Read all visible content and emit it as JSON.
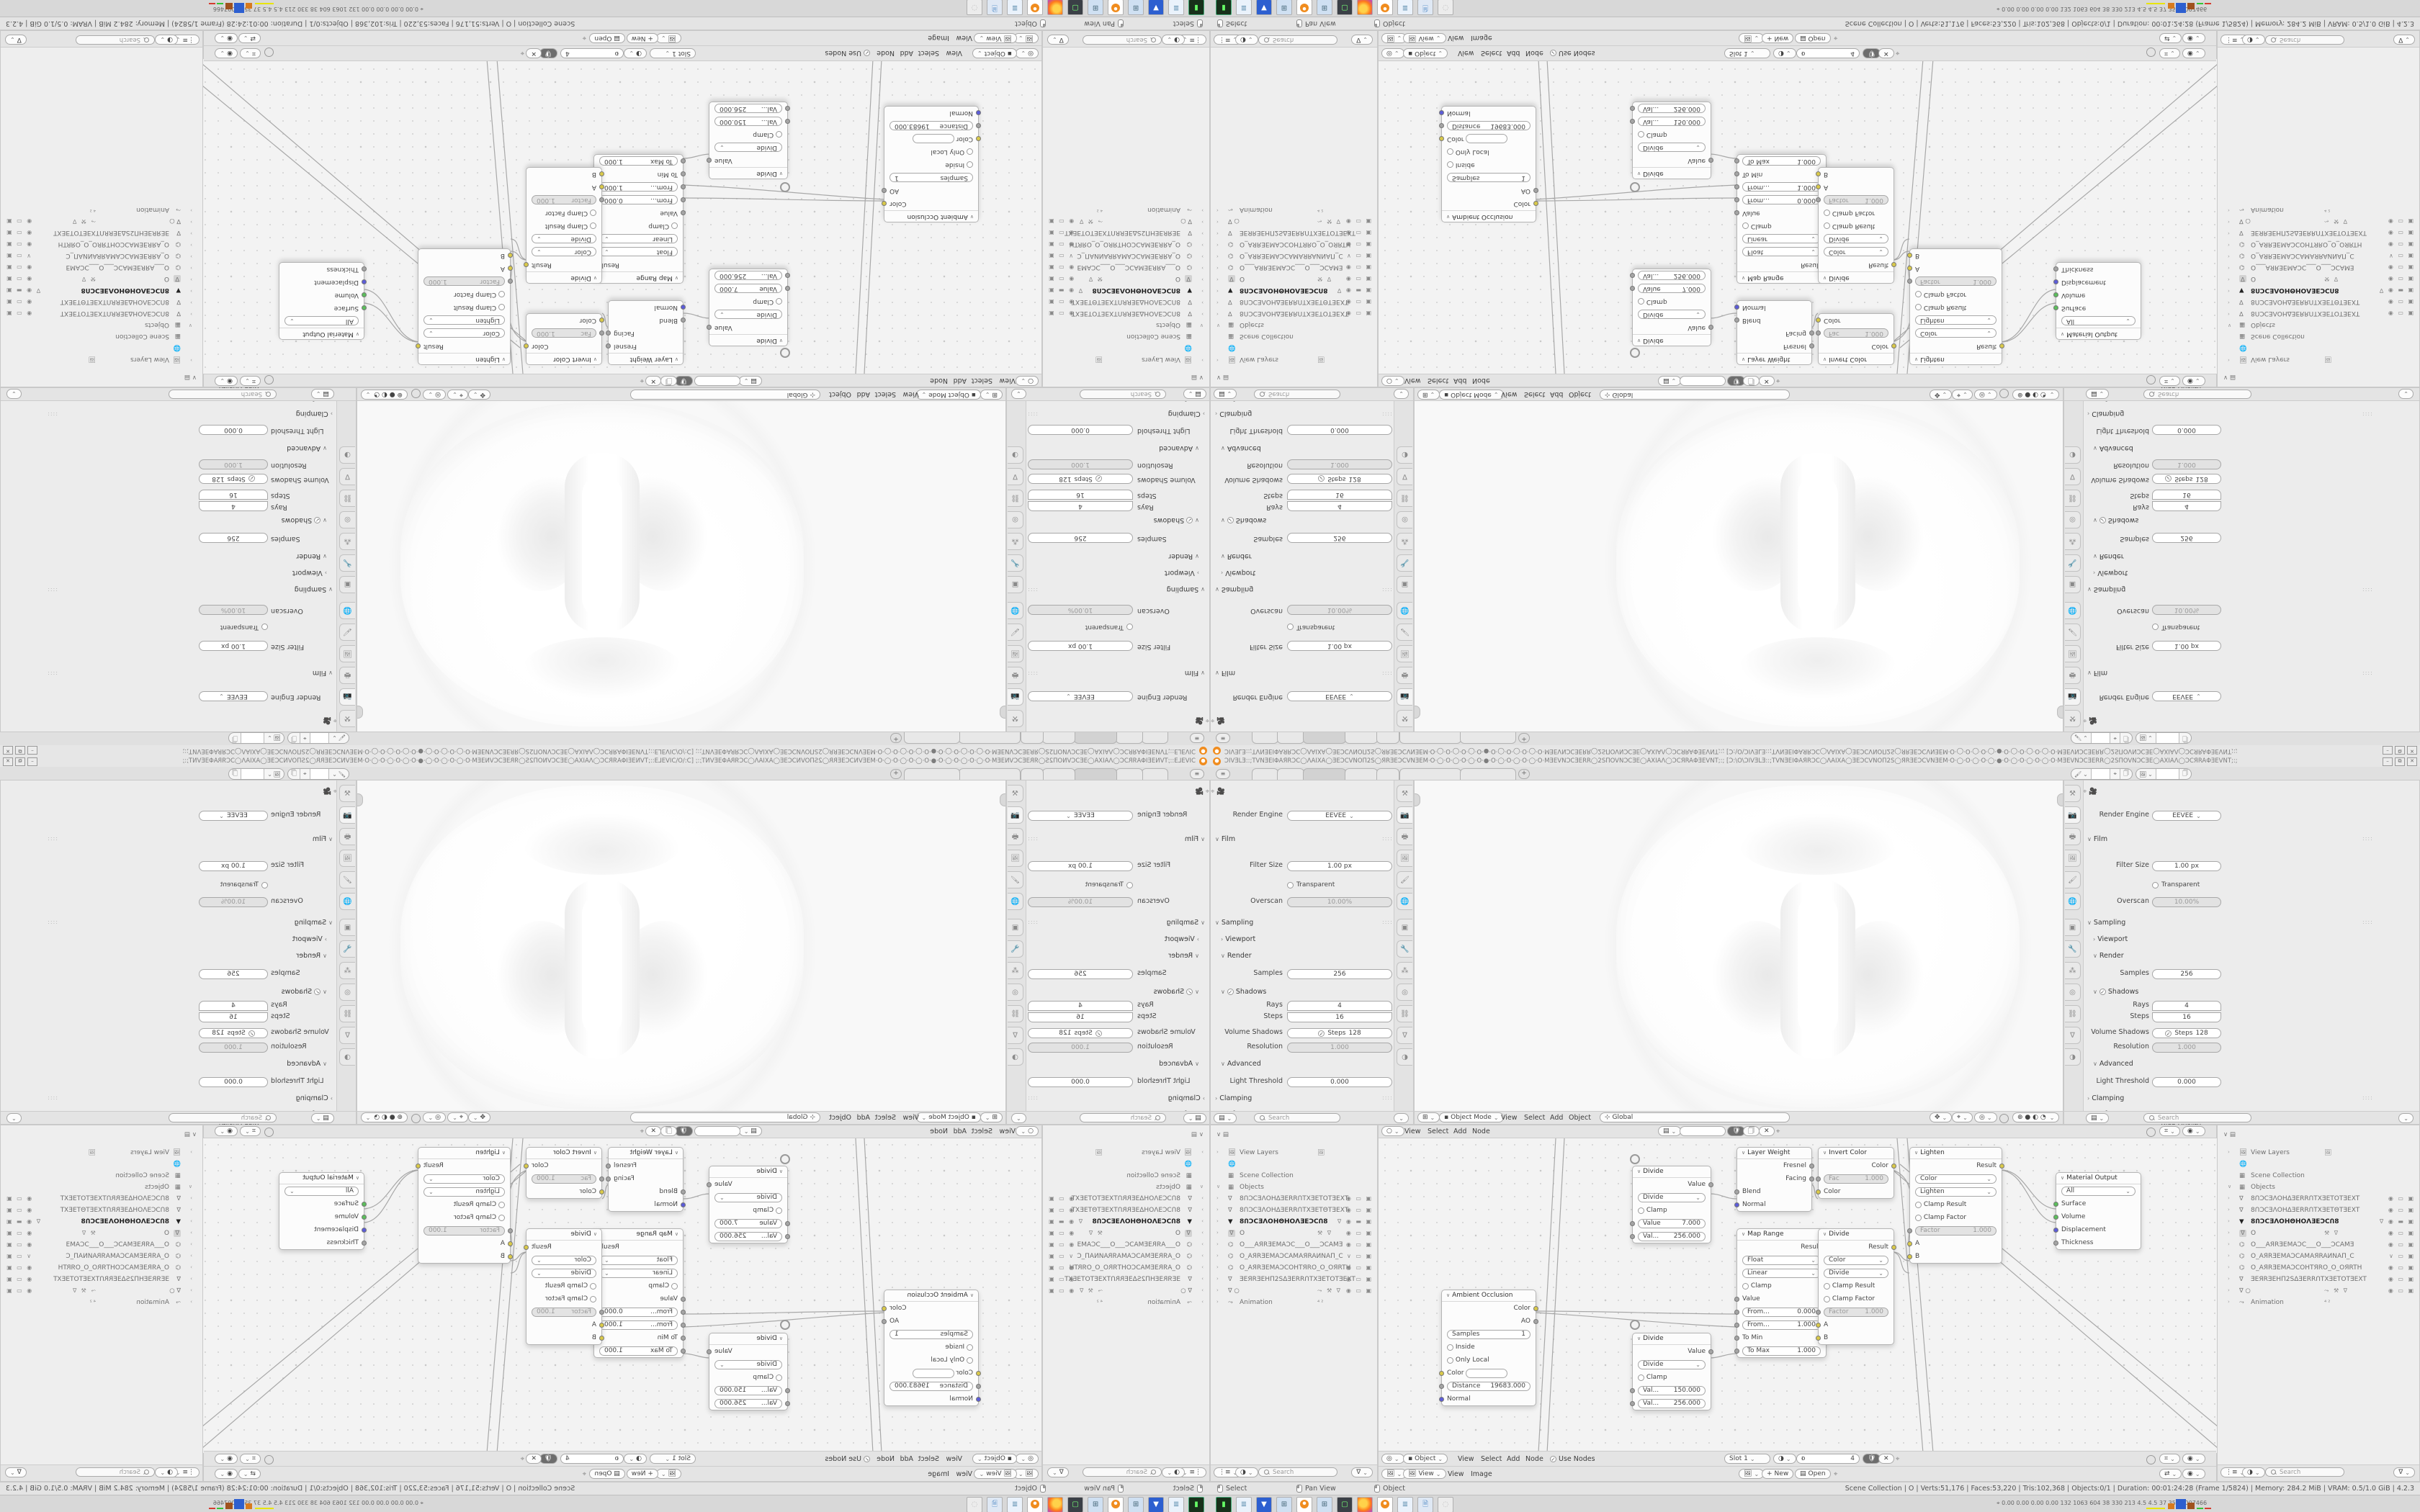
{
  "app": {
    "name": "Blender",
    "version": "4.2.3"
  },
  "colors": {
    "accent_orange": "#f08c1e",
    "socket_yellow": "#d9c94a",
    "socket_green": "#5cbe5c",
    "socket_blue": "#5c5cd9",
    "socket_grey": "#a5a5a5",
    "area_bg": "#ececec",
    "canvas_bg": "#f3f3f3"
  },
  "titlebar": {
    "title": "ƆIVƎLƎ::;TVNƎEIΦAЯRƆC◯ΛAIXA◯ƎEƆCVNOΠ2S◯ЯRƎEƆCVNƎEM·O·◯·O·◯·O·◯·O·●·O·◯·O·◯·O·◯·O·MƎEVNƆCƎERR◯2SΠOVNƆCƎE◯AXIAΛ◯ƆCЯRAΦƎEVNT;:;  [Ɔ:\\O\\ƆIVƎLƎ::;TVNƎEIΦAЯRƆC◯ΛAIXA◯ƎEƆCVNOΠ2S◯ЯRƎEƆCVNƎEM·O·◯·O·◯·O·◯·●·O·◯·O·◯·O·◯·O·MƎEVNƆCƎERR◯2SΠOVNƆCƎE◯AXIAΛ◯ƆCЯRAΦƎEVNT;:;",
    "minimize": "–",
    "maximize": "⧉",
    "close": "✕"
  },
  "topbar": {
    "hamburger": "≡",
    "add_tab": "+"
  },
  "props": {
    "render_engine_label": "Render Engine",
    "render_engine": "EEVEE",
    "film": "Film",
    "filter_size_label": "Filter Size",
    "filter_size": "1.00 px",
    "transparent": "Transparent",
    "overscan_label": "Overscan",
    "overscan": "10.00%",
    "sampling": "Sampling",
    "viewport": "Viewport",
    "render": "Render",
    "samples_label": "Samples",
    "samples": "256",
    "shadows": "Shadows",
    "rays_label": "Rays",
    "rays": "4",
    "steps_label": "Steps",
    "steps": "16",
    "volume_shadows_label": "Volume Shadows",
    "volume_steps_label": "Steps",
    "volume_steps": "128",
    "resolution_label": "Resolution",
    "resolution": "1.000",
    "advanced": "Advanced",
    "light_threshold_label": "Light Threshold",
    "light_threshold": "0.000",
    "clamping": "Clamping",
    "performance": "Performance",
    "hq_normals": "High Quality Normals",
    "search_placeholder": "Search"
  },
  "viewport": {
    "mode": "Object Mode",
    "m1": "View",
    "m2": "Select",
    "m3": "Add",
    "m4": "Object",
    "orientation": "Global"
  },
  "shader": {
    "m1": "View",
    "m2": "Select",
    "m3": "Add",
    "m4": "Node",
    "object": "Object",
    "use_nodes": "Use Nodes",
    "slot": "Slot 1",
    "users": "4",
    "nodes": {
      "ao": {
        "title": "Ambient Occlusion",
        "out_color": "Color",
        "out_ao": "AO",
        "samples_label": "Samples",
        "samples": "1",
        "inside": "Inside",
        "only_local": "Only Local",
        "color": "Color",
        "distance_label": "Distance",
        "distance": "19683.000",
        "normal": "Normal"
      },
      "m1": {
        "title": "Divide",
        "out": "Value",
        "op": "Divide",
        "clamp": "Clamp",
        "v1_label": "Value",
        "v1": "7.000",
        "v2_label": "Val...",
        "v2": "256.000"
      },
      "m3": {
        "title": "Divide",
        "out": "Value",
        "op": "Divide",
        "clamp": "Clamp",
        "v1_label": "Val...",
        "v1": "150.000",
        "v2_label": "Val...",
        "v2": "256.000"
      },
      "lw": {
        "title": "Layer Weight",
        "fresnel": "Fresnel",
        "facing": "Facing",
        "blend": "Blend",
        "normal": "Normal"
      },
      "mr": {
        "title": "Map Range",
        "out": "Result",
        "dtype": "Float",
        "interp": "Linear",
        "clamp": "Clamp",
        "value": "Value",
        "from_min_label": "From...",
        "from_min": "0.000",
        "from_max_label": "From...",
        "from_max": "1.000",
        "to_min": "To Min",
        "to_max_label": "To Max",
        "to_max": "1.000"
      },
      "ic": {
        "title": "Invert Color",
        "out": "Color",
        "fac_label": "Fac",
        "fac": "1.000",
        "in_color": "Color"
      },
      "mix": {
        "title": "Divide",
        "out": "Result",
        "dtype": "Color",
        "op": "Divide",
        "clamp_result": "Clamp Result",
        "clamp_factor": "Clamp Factor",
        "factor_label": "Factor",
        "factor": "1.000",
        "a": "A",
        "b": "B"
      },
      "lighten": {
        "title": "Lighten",
        "out": "Result",
        "dtype": "Color",
        "op": "Lighten",
        "clamp_result": "Clamp Result",
        "clamp_factor": "Clamp Factor",
        "factor_label": "Factor",
        "factor": "1.000",
        "a": "A",
        "b": "B"
      },
      "mo": {
        "title": "Material Output",
        "target": "All",
        "surface": "Surface",
        "volume": "Volume",
        "displacement": "Displacement",
        "thickness": "Thickness"
      }
    }
  },
  "image_editor": {
    "mode": "View",
    "m1": "View",
    "m2": "Image",
    "new_btn": "New",
    "open_btn": "Open"
  },
  "outliner": {
    "view_layers": "View Layers",
    "scene_collection": "Scene Collection",
    "objects": "Objects",
    "animation": "Animation",
    "anim_badge": "⁴²",
    "search_placeholder": "Search",
    "items": [
      {
        "name": "8ՈƆCƎΛOHΔƎERRՈTXƎETOTƎEXT"
      },
      {
        "name": "8ՈƆCƎΛOHΔƎERRՈTXƎETΘTƎEXT"
      },
      {
        "name": "8ՈƆCƎΛOHΘHOΛƎEƆCՈ8"
      },
      {
        "name": "O"
      },
      {
        "name": "O___AЯRƎEMAƆC___O___ƆCAMƎ"
      },
      {
        "name": "O_AЯRƎEMAƆCAMAЯRAИNAΠ_C"
      },
      {
        "name": "O_AЯRƎEMAƆCOHTЯRO_O_OЯRTH"
      },
      {
        "name": "ƎEЯRƎEHΠ2SΔƎERRՈTXƎETOTƎEXT"
      },
      {
        "name": ""
      }
    ]
  },
  "statusbar": {
    "hint1": "Select",
    "hint2": "Pan View",
    "hint3": "Object",
    "stats": "Scene Collection | O | Verts:51,176 | Faces:53,220 | Tris:102,368 | Objects:0/1 | Duration: 00:01:24:28 (Frame 1/5824) | Memory: 284.2 MiB | VRAM: 0.5/1.0 GiB | 4.2.3"
  },
  "taskbar": {
    "tray_numbers": "0.00 0.00 0.00 0.00  132 1063 604  38  330 213  4.5  4.5  37  35 59007466"
  }
}
